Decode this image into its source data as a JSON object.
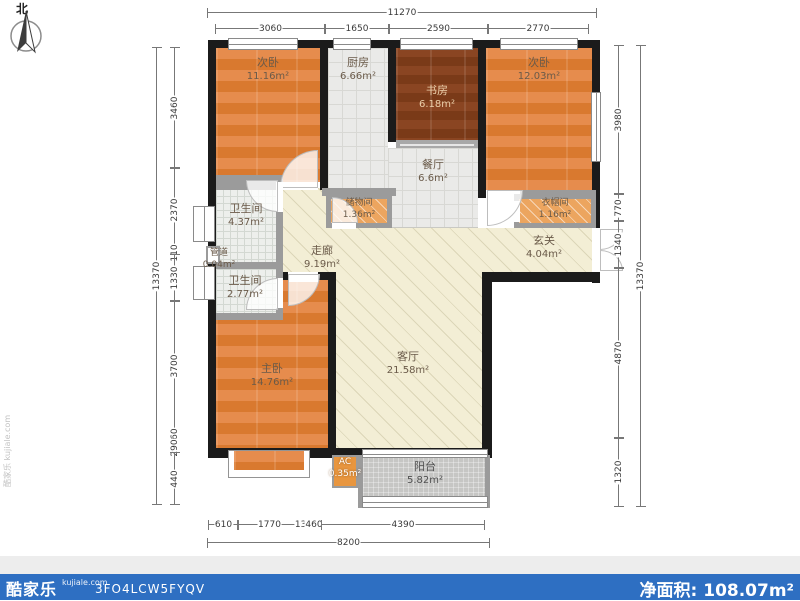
{
  "compass": {
    "label": "北"
  },
  "watermark": {
    "side_text": "酷家乐 kujiale.com"
  },
  "rooms": [
    {
      "id": "bedroom-left",
      "name": "次卧",
      "area": "11.16m²"
    },
    {
      "id": "kitchen",
      "name": "厨房",
      "area": "6.66m²"
    },
    {
      "id": "study",
      "name": "书房",
      "area": "6.18m²"
    },
    {
      "id": "bedroom-right",
      "name": "次卧",
      "area": "12.03m²"
    },
    {
      "id": "dining",
      "name": "餐厅",
      "area": "6.6m²"
    },
    {
      "id": "bathroom-1",
      "name": "卫生间",
      "area": "4.37m²"
    },
    {
      "id": "pipe-duct",
      "name": "管道",
      "area": "0.04m²"
    },
    {
      "id": "bathroom-2",
      "name": "卫生间",
      "area": "2.77m²"
    },
    {
      "id": "storage",
      "name": "储物间",
      "area": "1.36m²"
    },
    {
      "id": "cloakroom",
      "name": "衣帽间",
      "area": "1.16m²"
    },
    {
      "id": "corridor",
      "name": "走廊",
      "area": "9.19m²"
    },
    {
      "id": "entry",
      "name": "玄关",
      "area": "4.04m²"
    },
    {
      "id": "living",
      "name": "客厅",
      "area": "21.58m²"
    },
    {
      "id": "master",
      "name": "主卧",
      "area": "14.76m²"
    },
    {
      "id": "ac",
      "name": "AC",
      "area": "0.35m²"
    },
    {
      "id": "balcony",
      "name": "阳台",
      "area": "5.82m²"
    }
  ],
  "dimensions": {
    "top_total": "11270",
    "top_segments": [
      "3060",
      "1650",
      "2590",
      "2770"
    ],
    "bottom_segments": [
      "610",
      "1770",
      "130",
      "460",
      "4390"
    ],
    "bottom_total": "8200",
    "left_total": "13370",
    "left_segments": [
      "3460",
      "2370",
      "110",
      "1330",
      "3700",
      "360",
      "290",
      "440"
    ],
    "right_segments": [
      "3980",
      "770",
      "1340",
      "4870",
      "1320"
    ],
    "right_total": "13370"
  },
  "footer": {
    "logo": "酷家乐",
    "logo_domain": "kujiale.com",
    "plan_code": "3FO4LCW5FYQV",
    "net_area_label": "净面积:",
    "net_area_value": "108.07m²",
    "bar_color": "#2e6fc2"
  },
  "colors": {
    "wall": "#1b1b1b",
    "partition": "#9b9b9b",
    "wood_floor": "#e0813f",
    "dark_wood_floor": "#7f3d1b",
    "living_floor": "#f3eed5",
    "balcony_floor": "#c6c6c4"
  }
}
